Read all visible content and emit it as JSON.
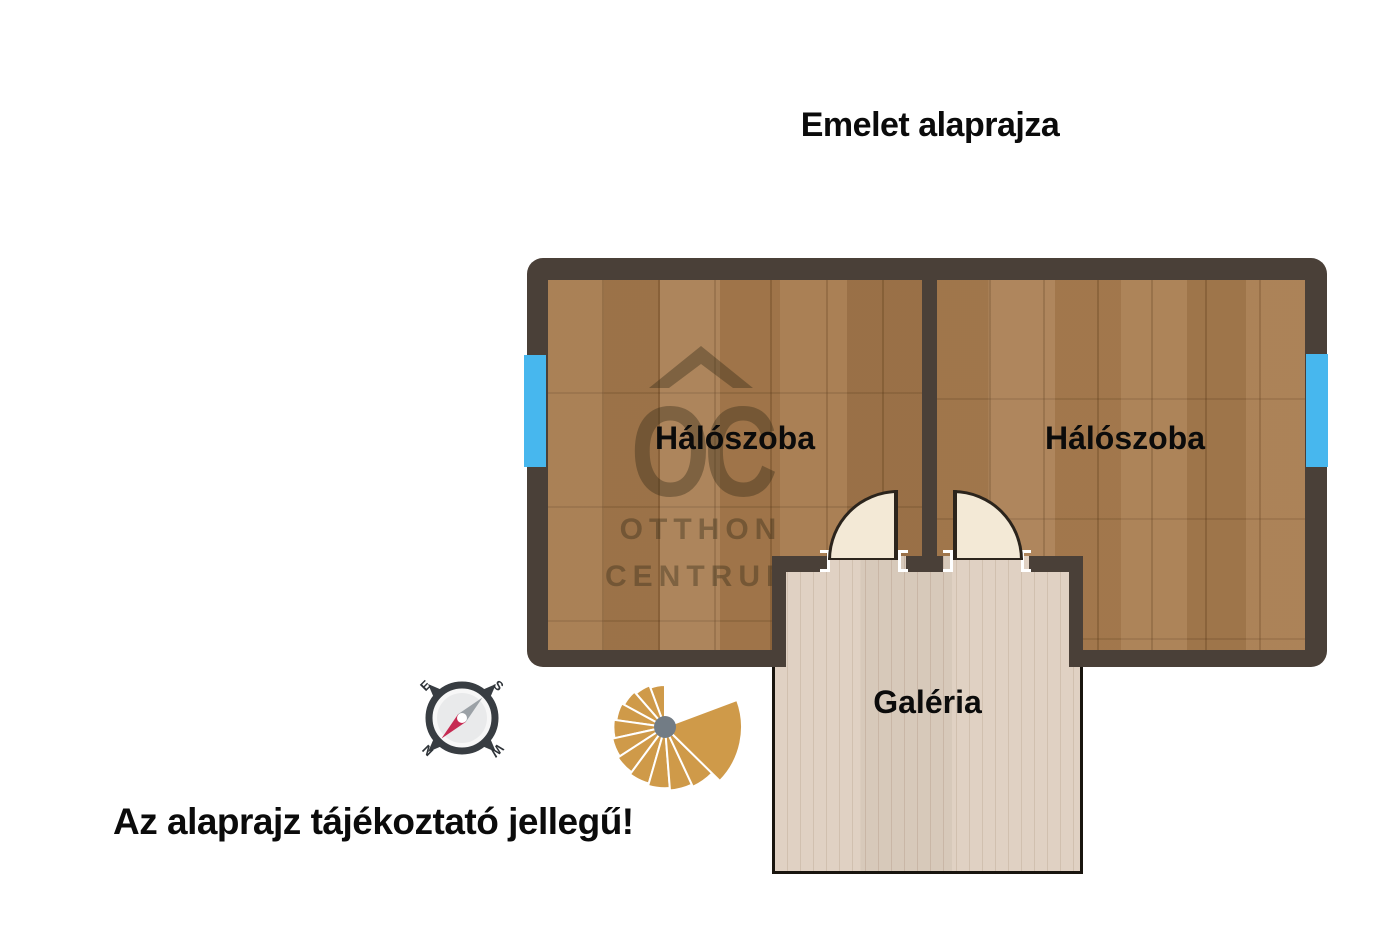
{
  "page": {
    "title": "Emelet alaprajza",
    "disclaimer": "Az alaprajz tájékoztató jellegű!"
  },
  "floorplan": {
    "rooms": [
      {
        "id": "bedroom-left",
        "label": "Hálószoba"
      },
      {
        "id": "bedroom-right",
        "label": "Hálószoba"
      },
      {
        "id": "gallery",
        "label": "Galéria"
      }
    ],
    "features": [
      "window-left",
      "window-right",
      "door-left",
      "door-right",
      "spiral-staircase",
      "compass"
    ]
  },
  "watermark": {
    "logo": "OC",
    "brand_line1": "OTTHON",
    "brand_line2": "CENTRUM"
  },
  "compass": {
    "north": "N",
    "south": "S",
    "east": "E",
    "west": "W"
  },
  "theme": {
    "wall": "#4a4038",
    "floor-wood": "#a5794c",
    "floor-wood-2": "#a87c4f",
    "floor-gallery": "#decfc0",
    "window-blue": "#47b7ee",
    "door-fill": "#f3e9d6",
    "door-line": "#2b241c",
    "stair-gold": "#cf9a49",
    "stair-hub": "#727c85",
    "compass-dark": "#383d42",
    "compass-red": "#c62b52",
    "compass-gray": "#9ba1a6",
    "text-black": "#0b0b0b",
    "watermark": "rgba(56,44,26,0.40)"
  }
}
